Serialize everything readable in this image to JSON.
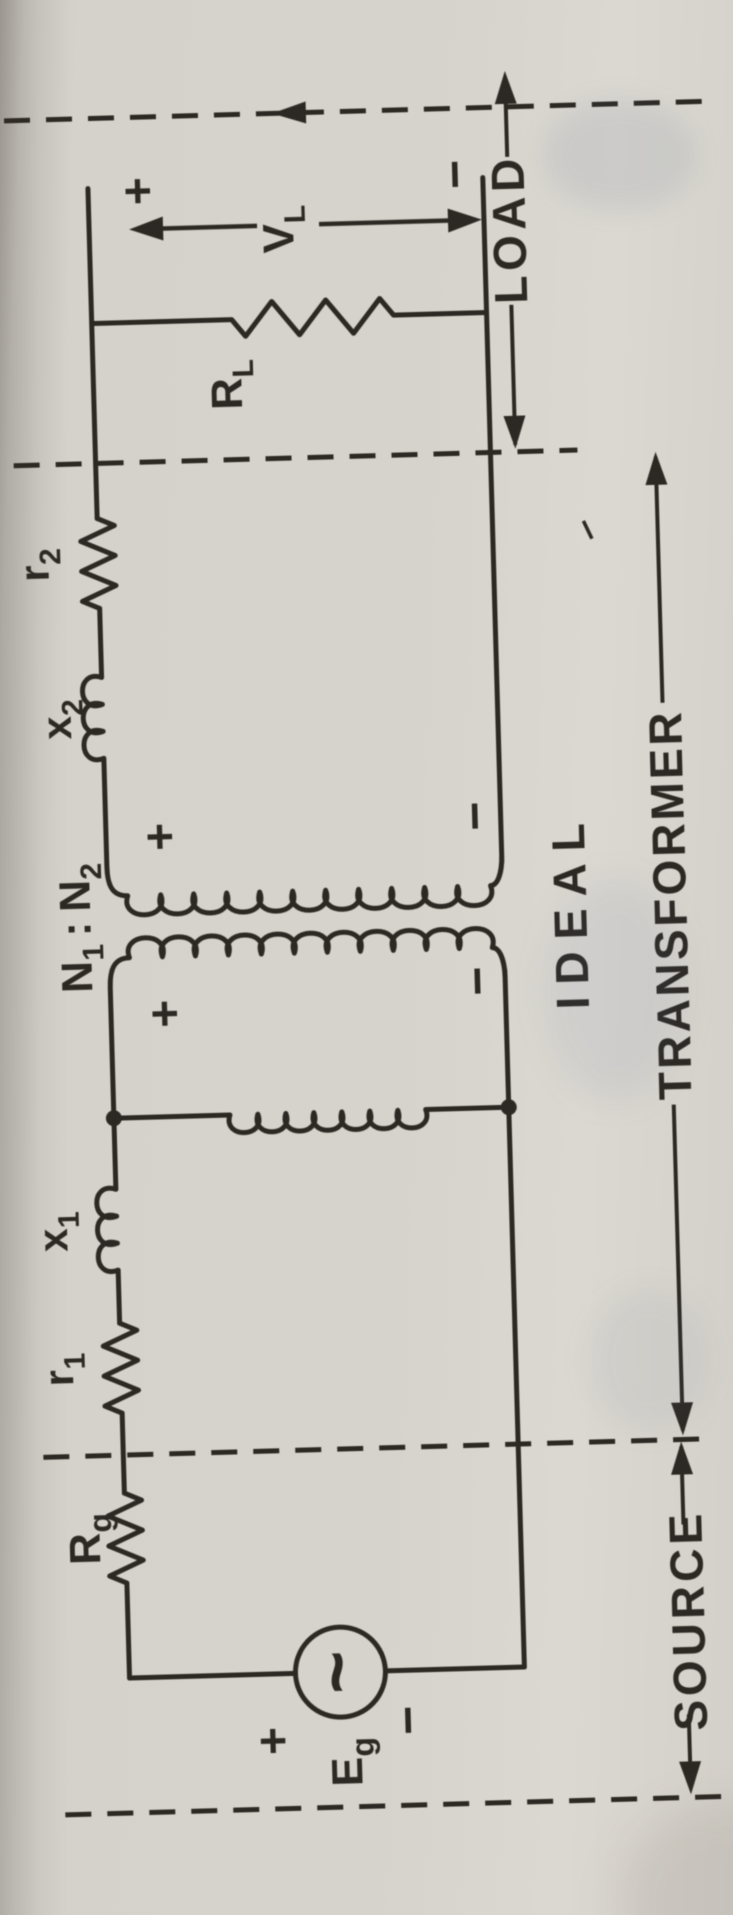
{
  "colors": {
    "paper": "#d5d2cb",
    "ink": "#2c2823"
  },
  "sections": {
    "source": "SOURCE",
    "transformer": "TRANSFORMER",
    "load": "LOAD",
    "ideal": "IDEAL"
  },
  "components": {
    "source_voltage": {
      "base": "E",
      "sub": "g"
    },
    "source_resistance": {
      "base": "R",
      "sub": "g"
    },
    "primary_resistance": {
      "base": "r",
      "sub": "1"
    },
    "primary_reactance": {
      "base": "x",
      "sub": "1"
    },
    "turns_ratio": {
      "n_left": "N",
      "n_left_sub": "1",
      "colon": ":",
      "n_right": "N",
      "n_right_sub": "2"
    },
    "secondary_reactance": {
      "base": "x",
      "sub": "2"
    },
    "secondary_resistance": {
      "base": "r",
      "sub": "2"
    },
    "load_resistance": {
      "base": "R",
      "sub": "L"
    },
    "load_voltage": {
      "base": "V",
      "sub": "L"
    }
  },
  "polarity": {
    "source_plus": "+",
    "source_minus": "−",
    "primary_plus": "+",
    "primary_minus": "−",
    "secondary_plus": "+",
    "secondary_minus": "−",
    "load_plus": "+",
    "load_minus": "−"
  },
  "icons": {
    "ac_source_icon": "~"
  }
}
